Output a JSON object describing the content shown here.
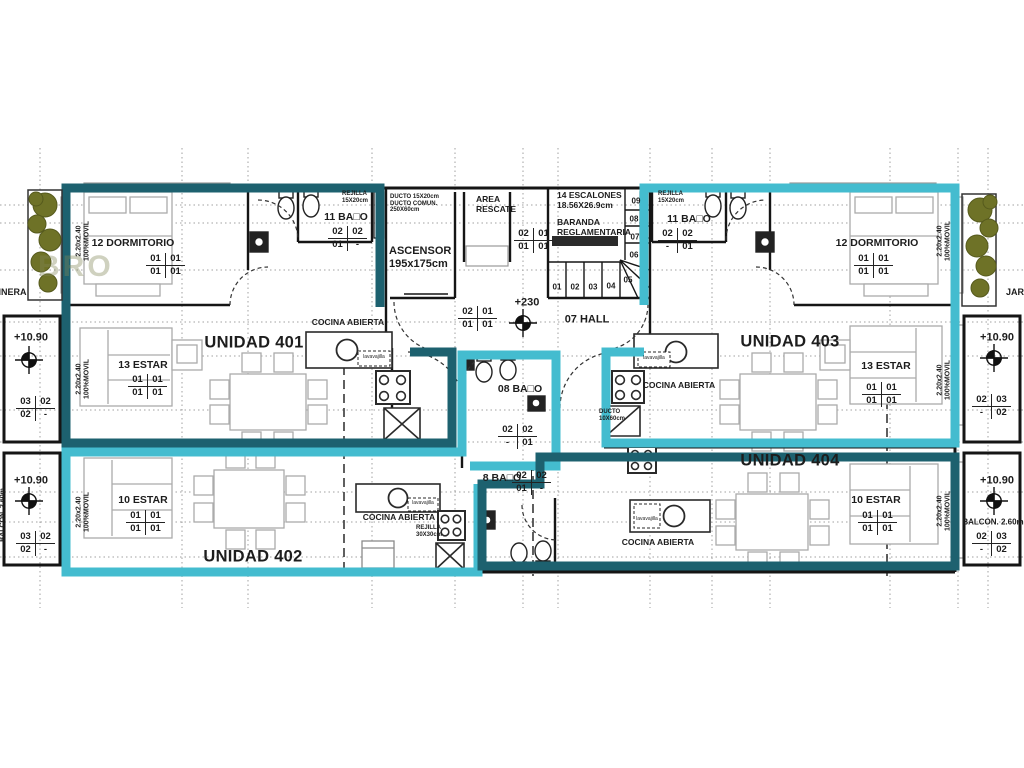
{
  "watermark": "BRO",
  "units": {
    "u401": "UNIDAD 401",
    "u402": "UNIDAD 402",
    "u403": "UNIDAD 403",
    "u404": "UNIDAD 404"
  },
  "rooms": {
    "dormitorio": "12 DORMITORIO",
    "estar13": "13 ESTAR",
    "estar10": "10 ESTAR",
    "bano11": "11 BA□O",
    "bano08": "08 BA□O",
    "bano08b": "8 BA□O",
    "cocina": "COCINA ABIERTA",
    "hall": "07 HALL",
    "ascensor_l1": "ASCENSOR",
    "ascensor_l2": "195x175cm",
    "rescate_l1": "AREA",
    "rescate_l2": "RESCATE",
    "escalones_l1": "14 ESCALONES",
    "escalones_l2": "18.56X26.9cm",
    "baranda_l1": "BARANDA",
    "baranda_l2": "REGLAMENTARIA",
    "jardinera": "JARDINERA",
    "balcon": "BALCON. 2.60m"
  },
  "annotations": {
    "movil_l1": "2.20x2.40",
    "movil_l2": "100%MOVIL",
    "rejilla15_l1": "REJILLA",
    "rejilla15_l2": "15X20cm",
    "rejilla30_l1": "REJILLA",
    "rejilla30_l2": "30X30cm",
    "ducto_asc_l1": "DUCTO 15X20cm",
    "ducto_asc_l2": "DUCTO COMUN.",
    "ducto_asc_l3": "250X60cm",
    "ducto10_l1": "DUCTO",
    "ducto10_l2": "10X60cm",
    "lavavajilla": "lavavajilla",
    "level_hall": "+230",
    "level_balcony": "+10.90"
  },
  "markers": {
    "estar_dorm": [
      "01",
      "01",
      "01",
      "01"
    ],
    "bano_left": [
      "02",
      "02",
      "01",
      "-"
    ],
    "bano_right": [
      "02",
      "02",
      "-",
      "01"
    ],
    "hall": [
      "02",
      "01",
      "01",
      "01"
    ],
    "balcony_left": [
      "03",
      "02",
      "02",
      "-"
    ],
    "balcony_right": [
      "02",
      "03",
      "-",
      "02"
    ]
  },
  "stairs": {
    "steps": [
      "01",
      "02",
      "03",
      "04",
      "05",
      "06",
      "07",
      "08",
      "09"
    ]
  },
  "colors": {
    "dark_teal": "#1d616f",
    "cyan": "#44bccf",
    "wall": "#151515",
    "plant": "#6e7227"
  }
}
